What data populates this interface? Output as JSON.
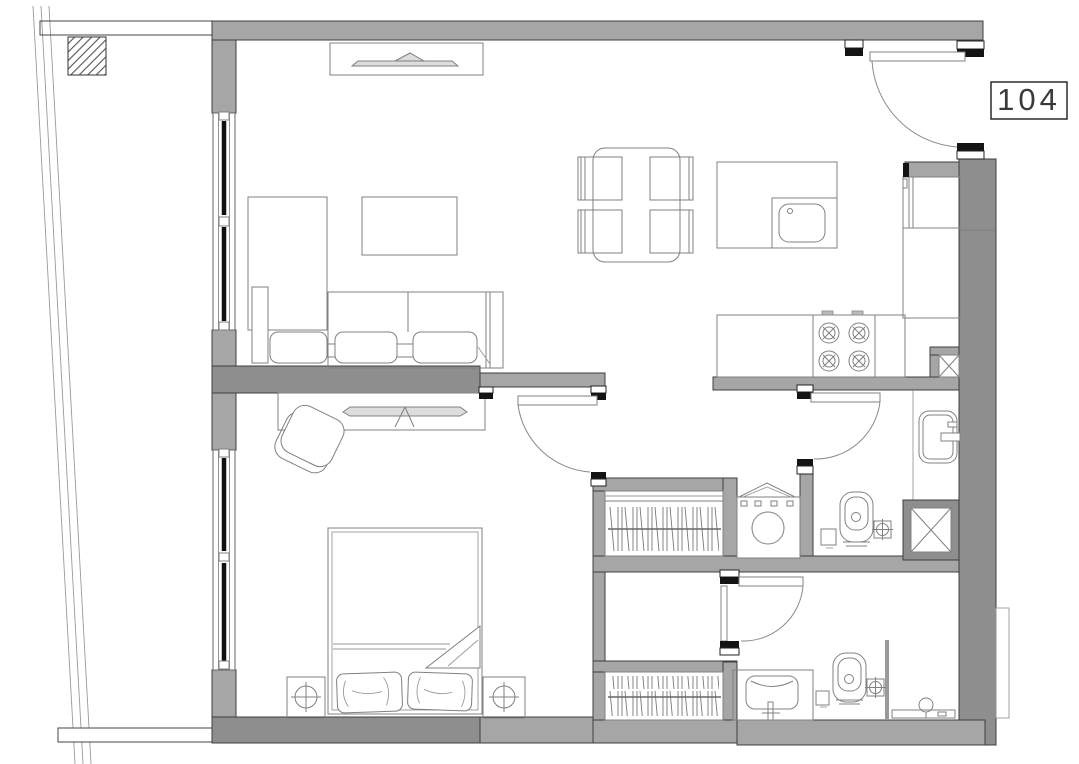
{
  "plan": {
    "unit_label": "104",
    "colors": {
      "paper": "#ffffff",
      "wall": "#a6a6a6",
      "wall_dark": "#8e8e8e",
      "line": "#3f3f3f",
      "draw": "#808080",
      "jamb": "#141414",
      "glazing": "#101010"
    }
  }
}
